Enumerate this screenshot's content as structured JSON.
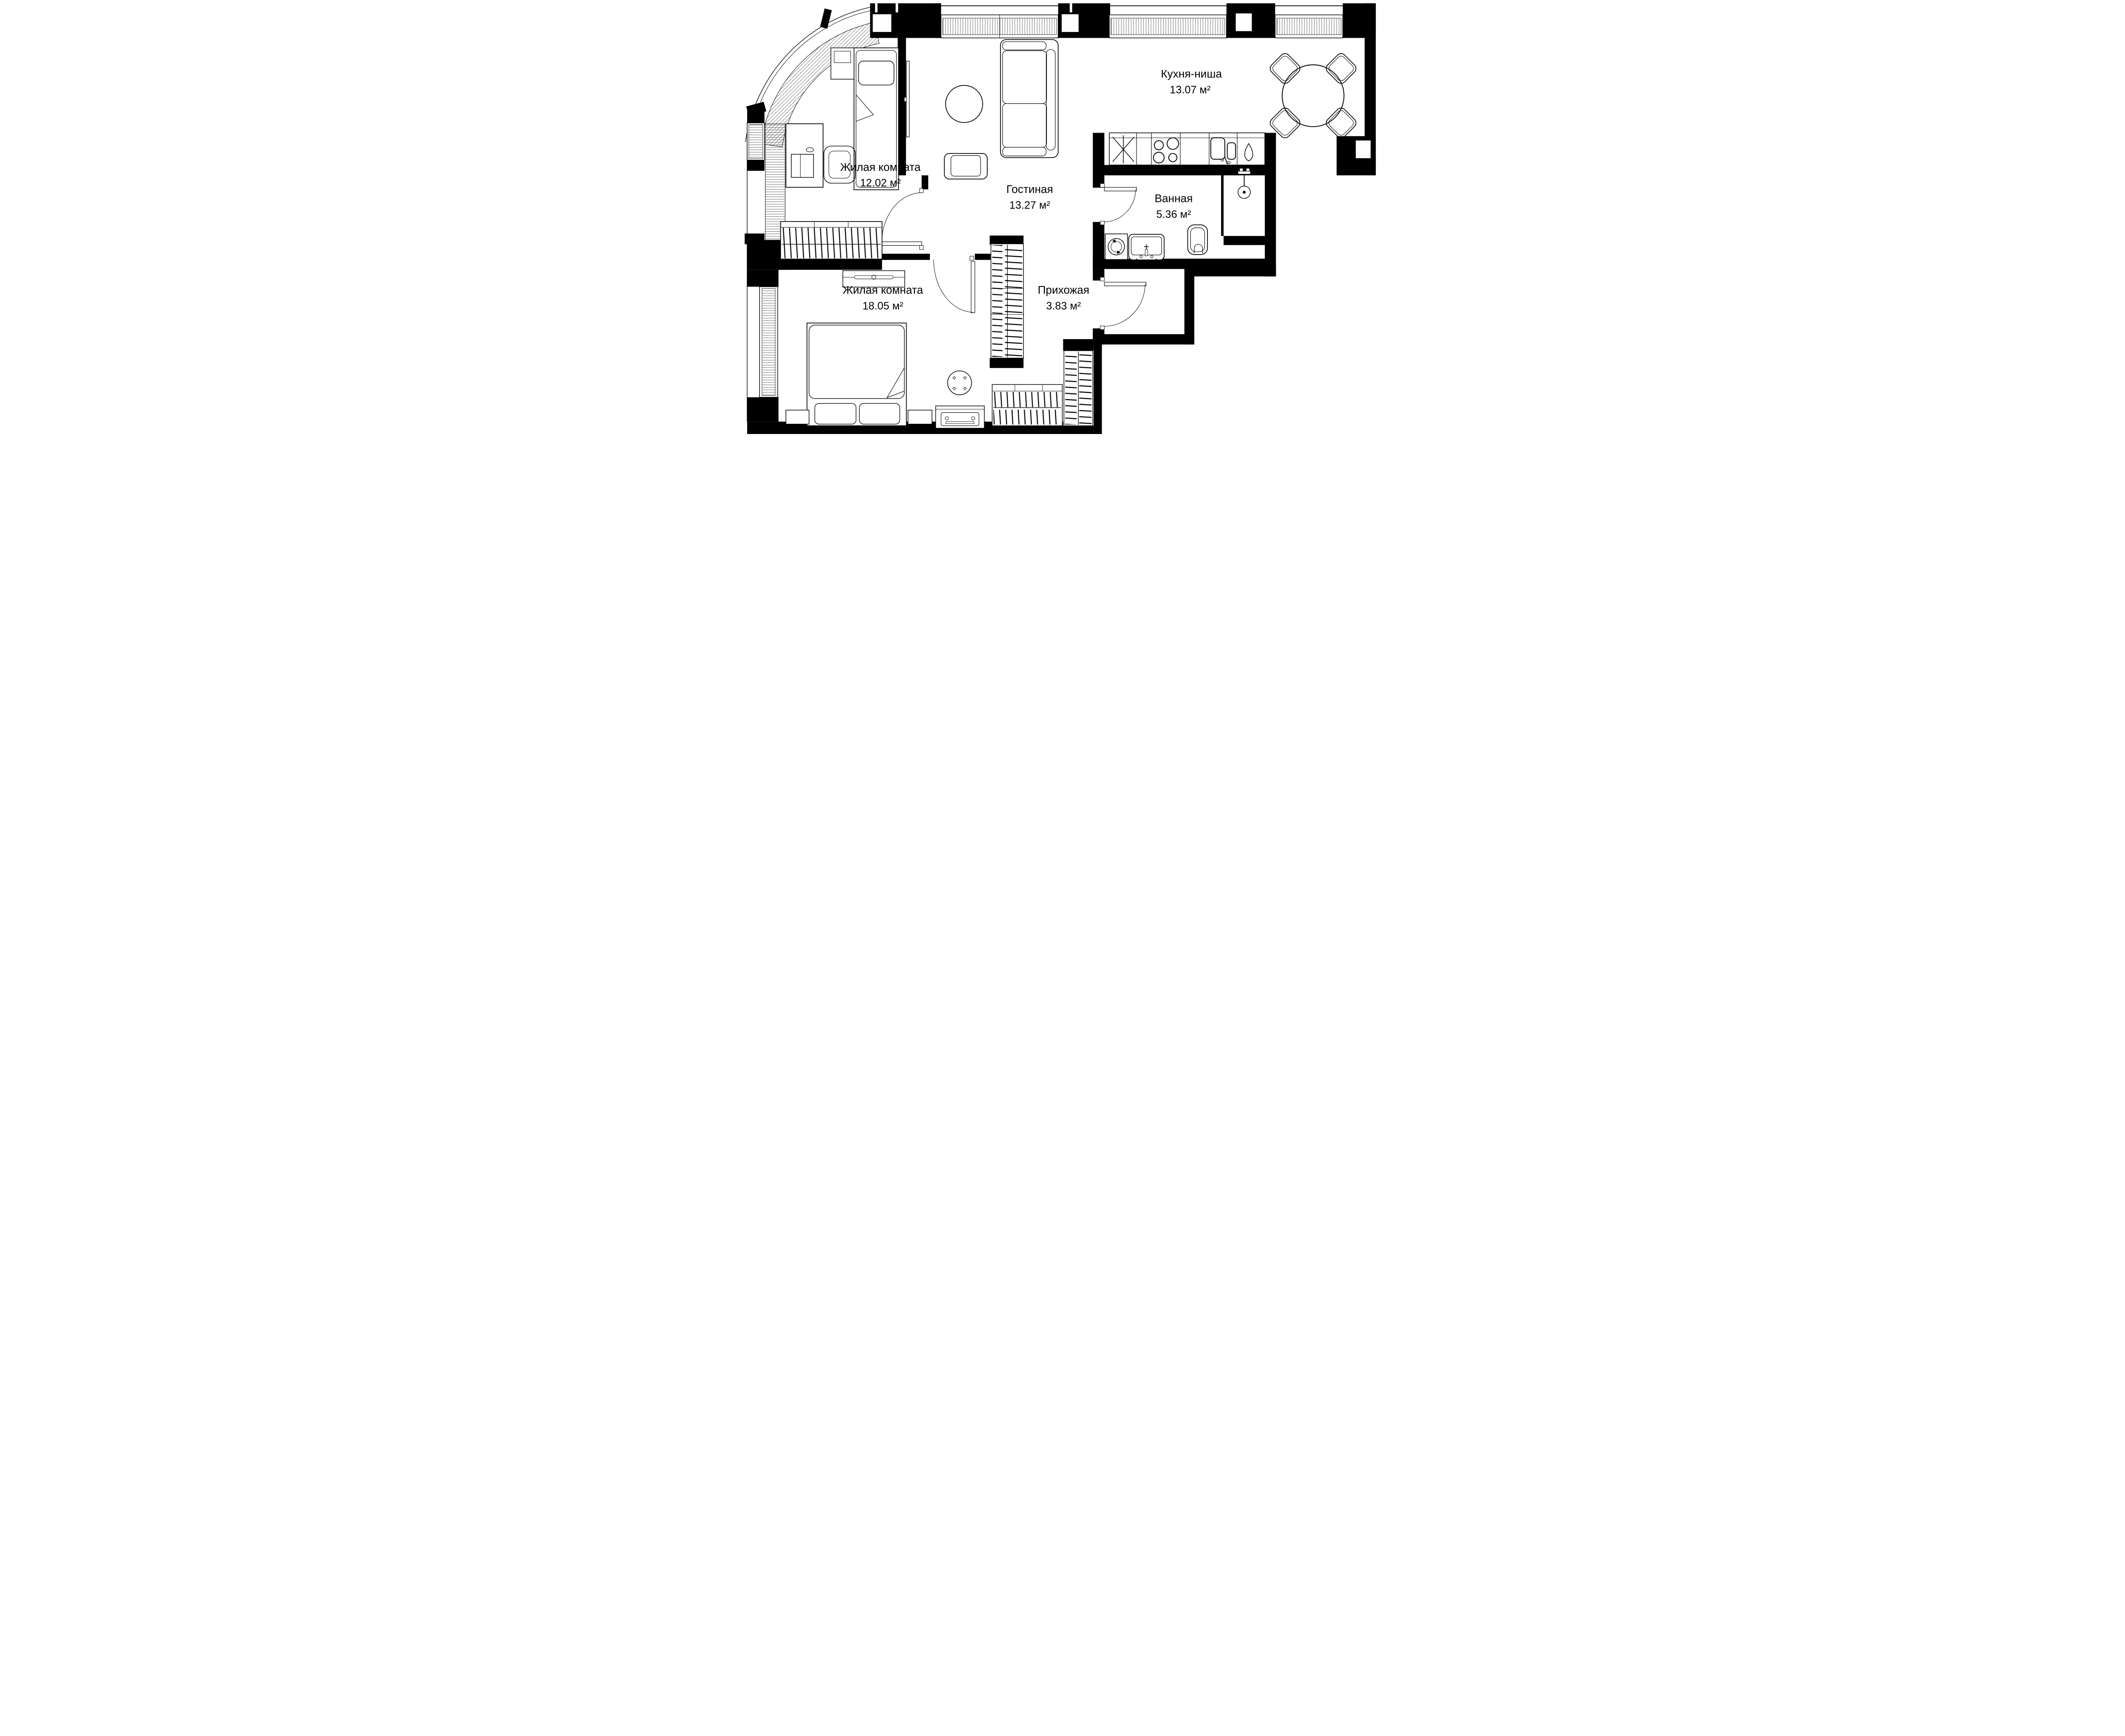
{
  "plan": {
    "type": "apartment-floor-plan",
    "language": "ru",
    "rooms": [
      {
        "id": "kitchen-niche",
        "label": "Кухня-ниша",
        "area": "13.07 м²"
      },
      {
        "id": "living-room",
        "label": "Гостиная",
        "area": "13.27 м²"
      },
      {
        "id": "bedroom-small",
        "label": "Жилая комната",
        "area": "12.02 м²"
      },
      {
        "id": "bathroom",
        "label": "Ванная",
        "area": "5.36 м²"
      },
      {
        "id": "bedroom-large",
        "label": "Жилая комната",
        "area": "18.05 м²"
      },
      {
        "id": "hallway",
        "label": "Прихожая",
        "area": "3.83 м²"
      }
    ],
    "colors": {
      "wall": "#000000",
      "line": "#000000",
      "background": "#ffffff"
    }
  }
}
